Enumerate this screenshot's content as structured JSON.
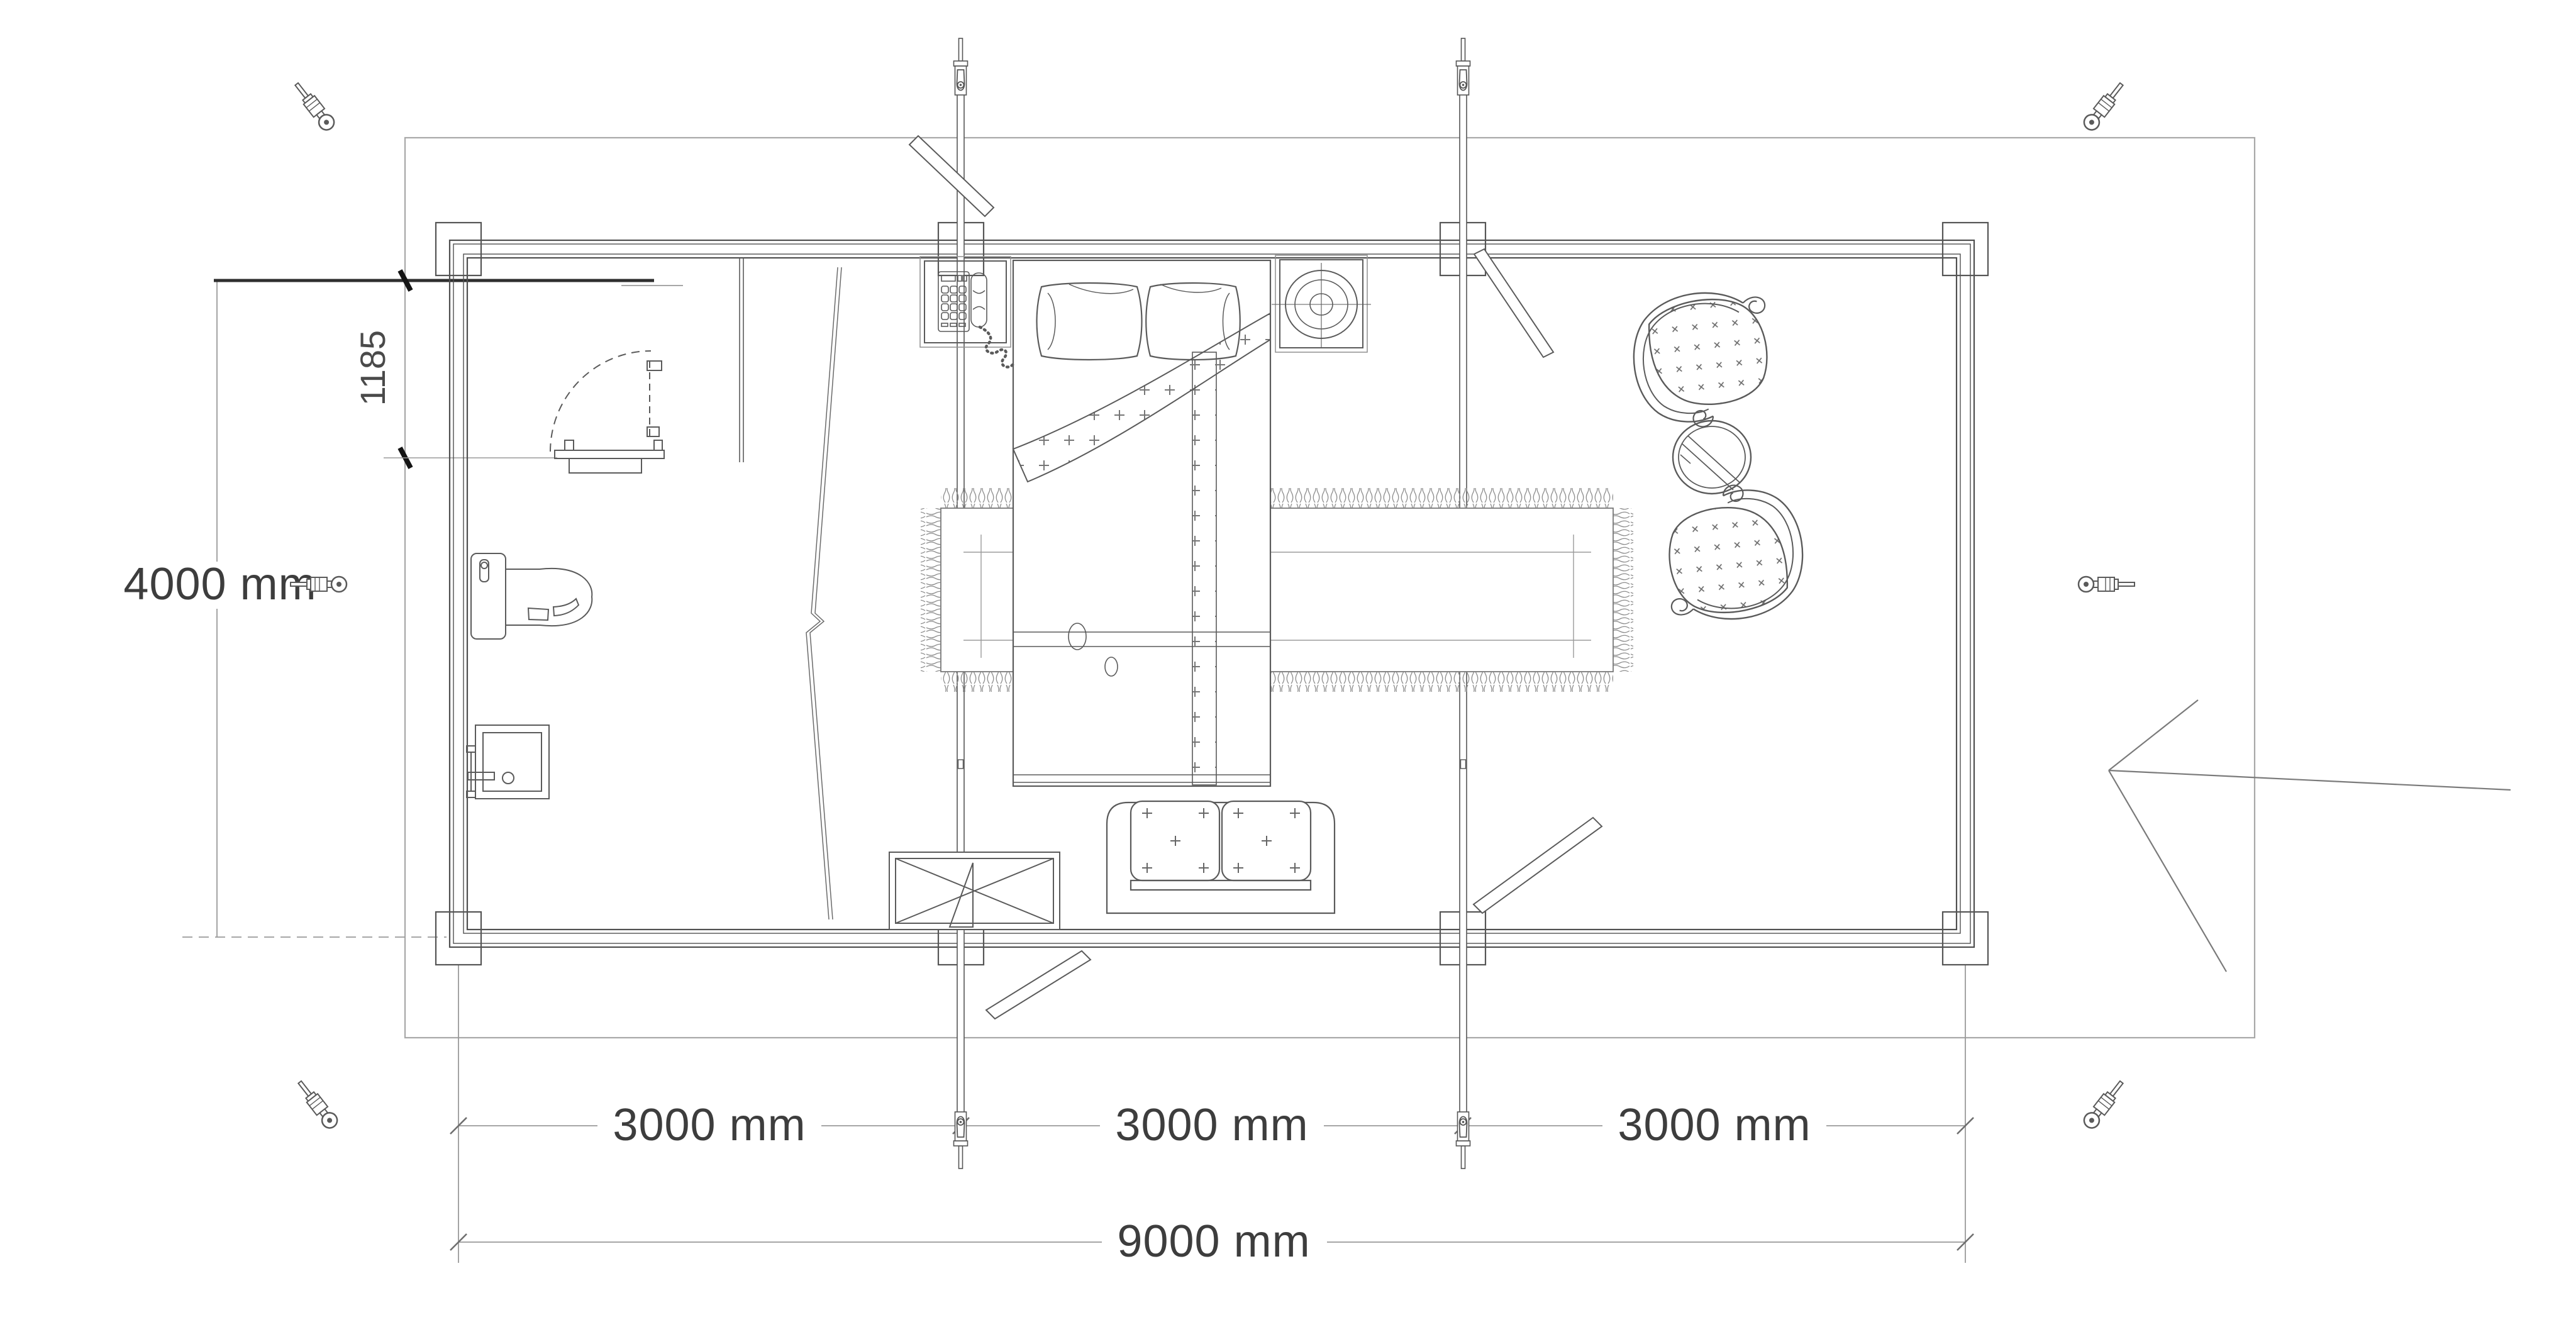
{
  "document": {
    "kind": "architectural-floor-plan",
    "description": "Top view plan of a 9000 x 4000 mm log cabin with bathroom, bedroom and sitting area"
  },
  "dimensions": {
    "height_label": "4000 mm",
    "door_offset_label": "1185",
    "bay_labels": [
      "3000 mm",
      "3000 mm",
      "3000 mm"
    ],
    "width_label": "9000 mm"
  },
  "rooms": [
    "bathroom",
    "bedroom",
    "sitting-area"
  ],
  "furniture": [
    "toilet",
    "sink",
    "bathroom-door",
    "bed",
    "pillows",
    "blanket",
    "telephone-nightstand",
    "lamp-nightstand",
    "rug",
    "sofa",
    "coffee-table",
    "wing-chair-top",
    "wing-chair-bottom",
    "round-table"
  ],
  "symbols": [
    "storm-rod-left",
    "storm-rod-right",
    "turnbuckle-screws",
    "corner-posts",
    "storm-braces",
    "entry-arrow",
    "break-line"
  ],
  "colors": {
    "wall_line": "#4f4f4f",
    "furniture_line": "#5a5a5a",
    "boundary_line": "#a8a8a8",
    "dimension_line": "#9a9a9a",
    "text": "#3d3d3d",
    "tick": "#141414",
    "background": "#ffffff"
  }
}
